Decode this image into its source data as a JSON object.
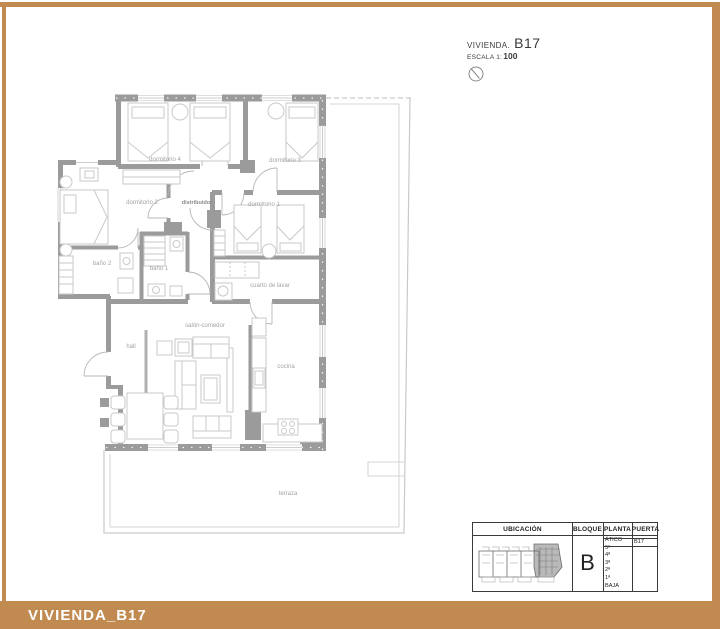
{
  "colors": {
    "frame": "#c18a50",
    "wall": "#9b9b9b"
  },
  "title_block": {
    "project_label": "VIVIENDA.",
    "unit": "B17",
    "scale_label": "ESCALA 1:",
    "scale_value": "100"
  },
  "floorplan": {
    "rooms": {
      "dormitorio4": "dormitorio 4",
      "dormitorio3": "dormitorio 3",
      "dormitorio2": "dormitorio 2",
      "dormitorio1": "dormitorio 1",
      "distribuidor": "distribuidor",
      "bano2": "baño 2",
      "bano1": "baño 1",
      "cuarto_lavar": "cuarto de lavar",
      "salon": "salón-comedor",
      "hall": "hall",
      "cocina": "cocina",
      "terraza": "terraza"
    }
  },
  "info_table": {
    "headers": [
      "UBICACIÓN",
      "BLOQUE",
      "PLANTA",
      "PUERTA"
    ],
    "bloque": "B",
    "plantas": [
      "ÁTICO",
      "5ª",
      "4ª",
      "3ª",
      "2ª",
      "1ª",
      "BAJA"
    ],
    "highlighted_planta": "ÁTICO",
    "puerta": "B17"
  },
  "footer": {
    "title": "VIVIENDA_B17"
  }
}
